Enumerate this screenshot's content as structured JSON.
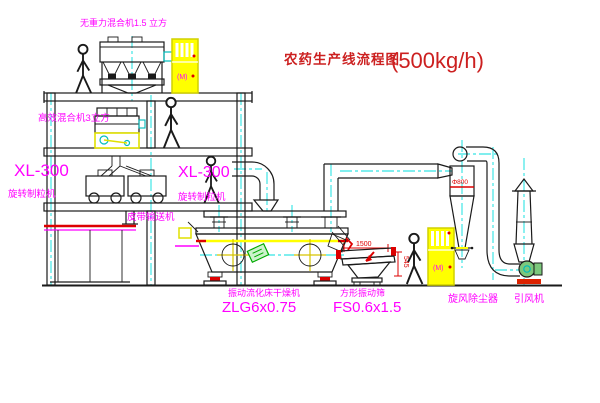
{
  "title": {
    "name": "农药生产线流程图",
    "capacity": "(500kg/h)"
  },
  "equipment": {
    "gravity_mixer": "无重力混合机1.5 立方",
    "high_eff_mixer": "高效混合机3立方",
    "granulator_left_model": "XL-300",
    "granulator_left_name": "旋转制粒机",
    "granulator_mid_model": "XL-300",
    "granulator_mid_name": "旋转制粒机",
    "belt_conveyor": "皮带输送机",
    "dryer_name": "振动流化床干燥机",
    "dryer_model": "ZLG6x0.75",
    "screen_name": "方形振动筛",
    "screen_model": "FS0.6x1.5",
    "cyclone_name": "旋风除尘器",
    "fan_name": "引风机"
  },
  "dimensions": {
    "screen_length": "1500",
    "screen_height": "545",
    "cyclone_marking": "Φ800"
  },
  "panel_mark": "(M)",
  "colors": {
    "line": "#1a1a1a",
    "centerline": "#00dede",
    "label": "#ff00ff",
    "title": "#cc2020",
    "dimension": "#dd0000",
    "cabinet": "#ffff00",
    "logo_green": "#00aa00"
  }
}
